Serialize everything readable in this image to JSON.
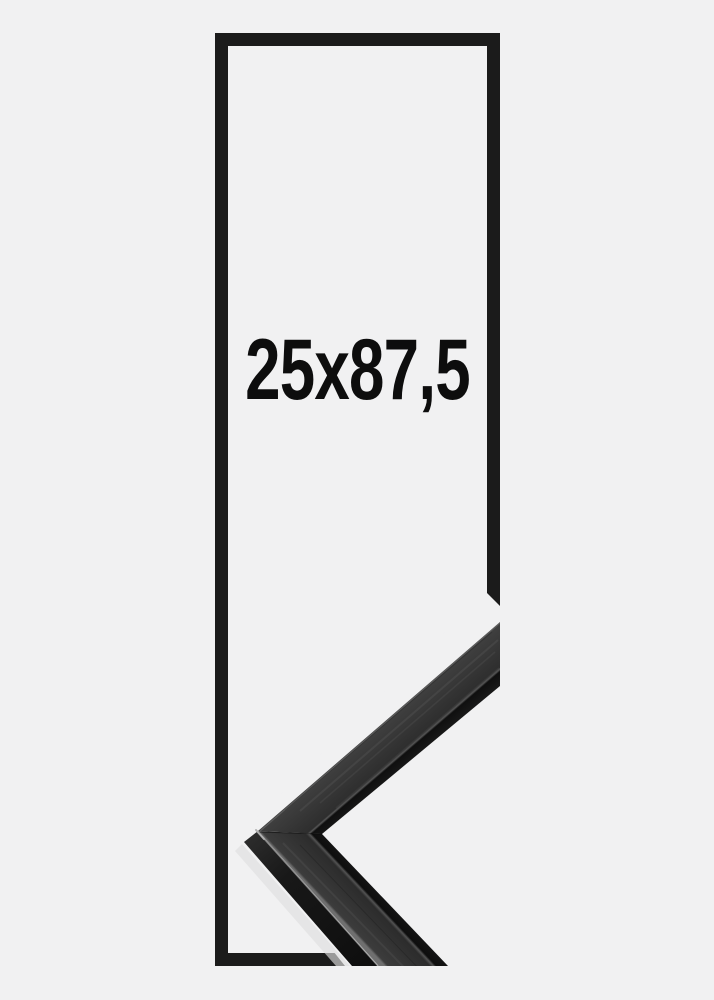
{
  "page": {
    "background_color": "#f1f1f2"
  },
  "product_preview": {
    "size_label": "25x87,5",
    "outline": {
      "color": "#1b1b1b"
    },
    "corner_photo": {
      "name": "black-frame-corner-sample",
      "face_color": "#313131",
      "lip_color": "#0f0f0f",
      "edge_highlight_color": "#8a8a8a",
      "backdrop_color": "#f1f1f2"
    }
  }
}
